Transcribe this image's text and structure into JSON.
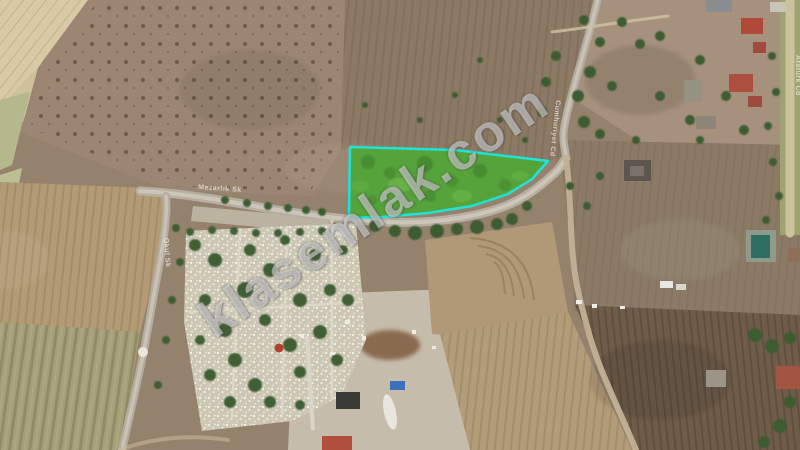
{
  "watermark": {
    "text": "klasemlak.com"
  },
  "parcel": {
    "name": "highlighted-land-parcel",
    "fill": "#55a33a",
    "stroke": "#1fe3d8"
  },
  "road_labels": [
    {
      "id": "main-road",
      "text": "Mezarlık Sk"
    },
    {
      "id": "west-road",
      "text": "Okul Sk"
    },
    {
      "id": "north-road",
      "text": "Cumhuriyet Cd"
    },
    {
      "id": "east-road",
      "text": "Atatürk Cd"
    }
  ],
  "colors": {
    "parcel_fill": "#55a33a",
    "parcel_border": "#1fe3d8",
    "road": "#b6afa2",
    "cemetery_base": "#ccc6b4",
    "dark_field": "#6f5c49"
  }
}
